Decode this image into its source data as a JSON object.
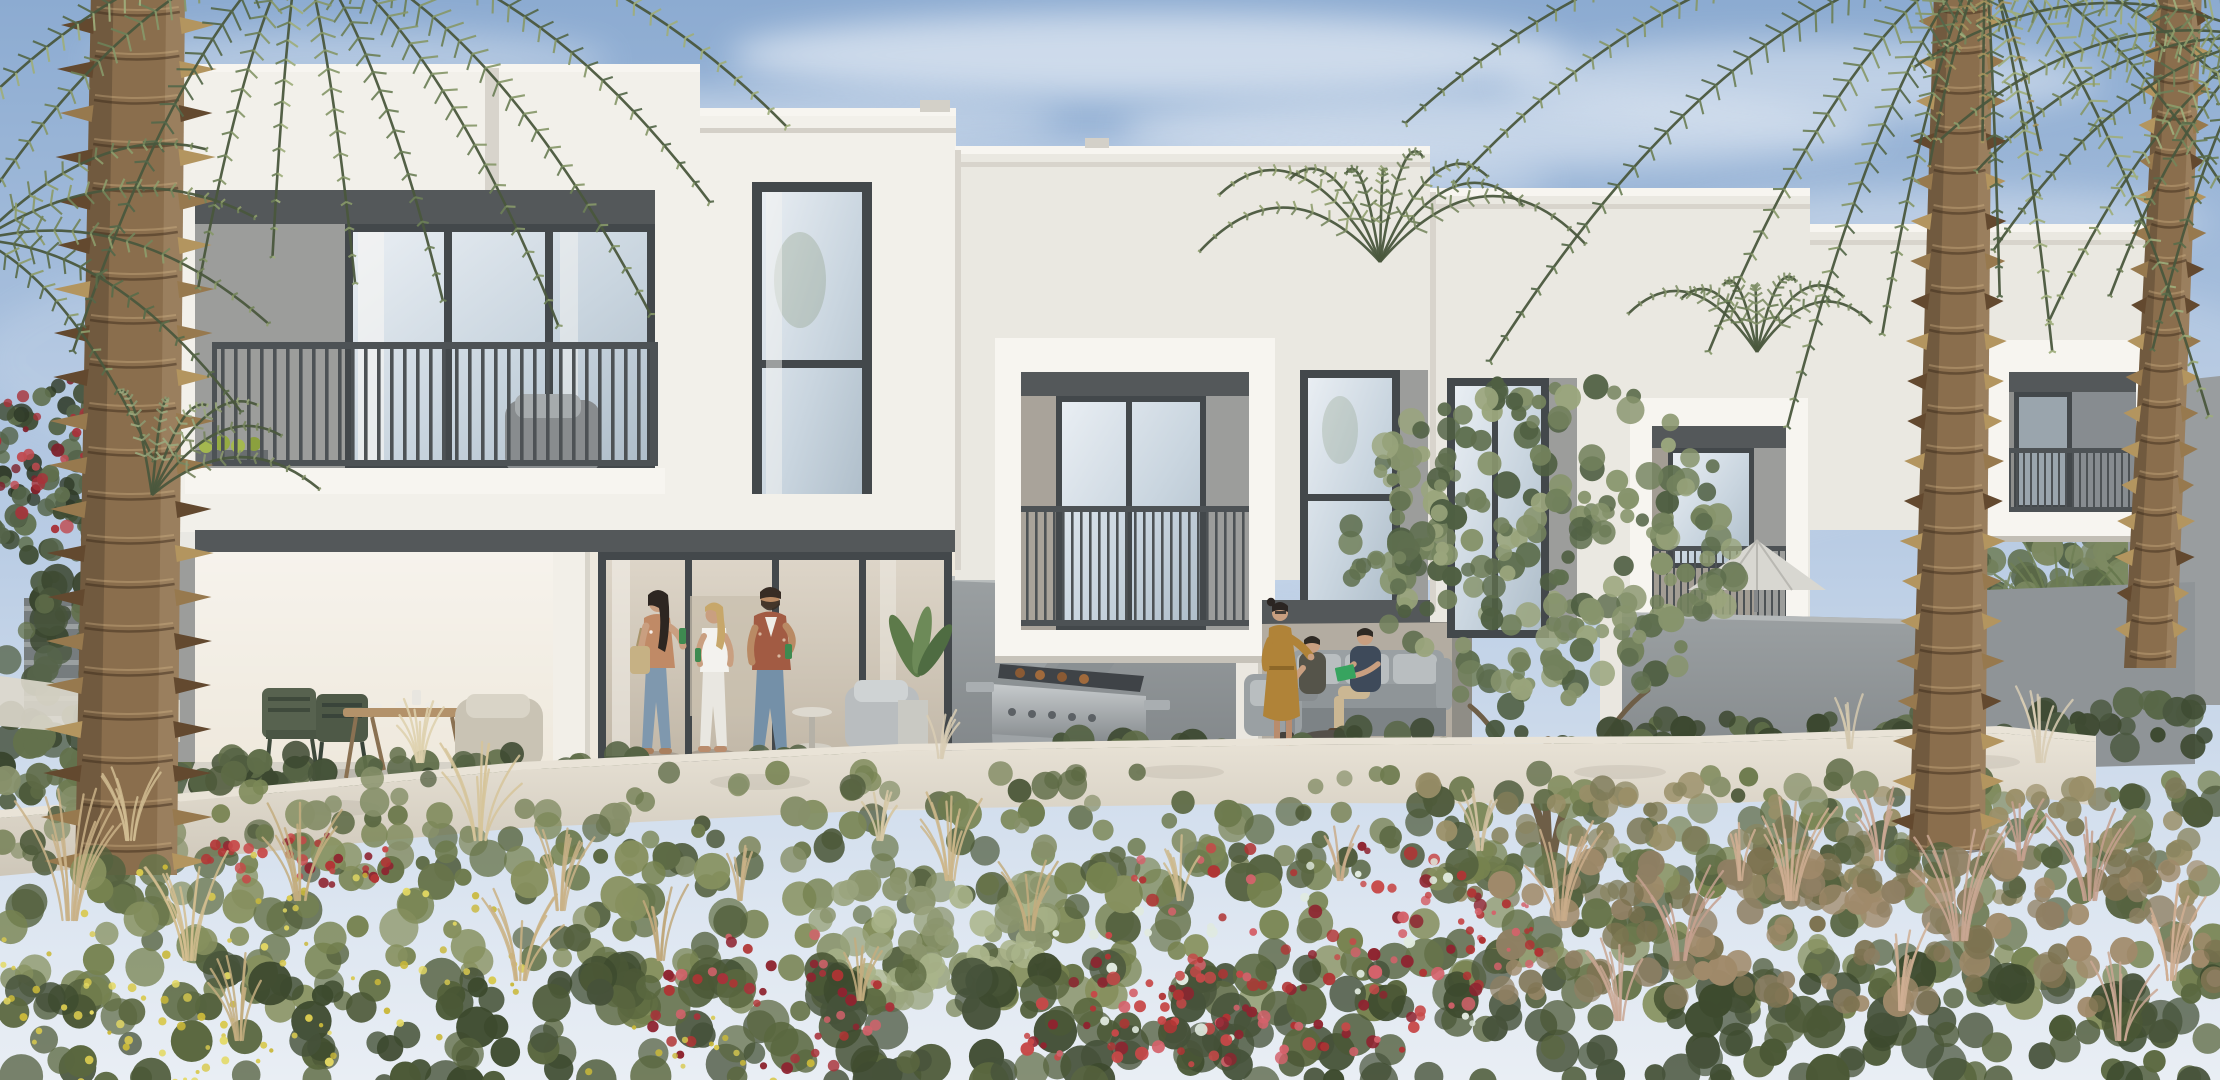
{
  "alt": "Architectural rendering of a row of modern white two-storey townhouses with dark-framed windows and balconies, ground-floor patios with people, outdoor furniture and a barbecue grill, palm trees on both sides, and a wild flowering garden with red and yellow blooms in the foreground under a soft blue sky",
  "scene": {
    "seed": 11,
    "colors": {
      "sky_top": "#8cabd1",
      "sky_mid": "#b9cce4",
      "sky_low": "#dde6f1",
      "facade": "#f2f0ea",
      "facade_bright": "#f7f5f0",
      "facade_dim": "#eae8e1",
      "facade_shade": "#d8d4cc",
      "soffit": "#54585a",
      "accent_panel": "#9c9d9b",
      "frame": "#43484b",
      "railing": "#4d5255",
      "glass_hi": "#e9eef3",
      "glass_mid": "#c9d5df",
      "glass_lo": "#aebdc9",
      "glass_warm_hi": "#ddd5c8",
      "glass_warm_lo": "#c2b8a8",
      "wall_grey_hi": "#9ba0a2",
      "wall_grey_lo": "#808588",
      "pilaster": "#eae7e0",
      "white_wall_hi": "#e9e3d7",
      "white_wall_lo": "#cec7b9",
      "patio_floor": "#d6d2c8",
      "curb": "#e5e1d6",
      "skin": "#c99f80",
      "skin_kid": "#d7ad8a",
      "denim": "#7f98ae",
      "rust": "#a25b43",
      "mustard": "#b08338",
      "navy": "#3e4a5a",
      "olive_shirt": "#55544a",
      "white_cloth": "#f2f1ec",
      "bottle": "#3e8a50",
      "book": "#37a45f",
      "red_shorts": "#c04436",
      "umbrella": "#d8d7d1",
      "bbq_steel": "#a9aeb1",
      "bbq_dark": "#4e5356",
      "sofa": "#9aa0a3",
      "cushion": "#b9bec0",
      "wood": "#b3926a",
      "chair_green": "#57624f",
      "pot": "#d4d4cf",
      "trunk": "#8a6e4d",
      "trunk_dark": "#63492f",
      "trunk_light": "#b3955f",
      "rachis": "#4a573d"
    },
    "clouds": [
      [
        1150,
        55,
        420,
        42,
        0.55
      ],
      [
        760,
        120,
        300,
        30,
        0.35
      ],
      [
        1500,
        130,
        380,
        36,
        0.45
      ],
      [
        1800,
        80,
        300,
        40,
        0.4
      ],
      [
        350,
        60,
        260,
        30,
        0.3
      ],
      [
        1050,
        180,
        500,
        40,
        0.3
      ],
      [
        1950,
        220,
        260,
        30,
        0.3
      ],
      [
        600,
        210,
        300,
        26,
        0.22
      ],
      [
        1100,
        420,
        900,
        160,
        0.16
      ],
      [
        1900,
        380,
        400,
        120,
        0.14
      ],
      [
        400,
        360,
        420,
        120,
        0.12
      ]
    ],
    "bg_clusters": [
      {
        "cx": 55,
        "cy": 480,
        "rx": 72,
        "ry": 98,
        "n": 80,
        "r0": 5,
        "r1": 12,
        "c": [
          "#3f4c33",
          "#55644a",
          "#2f3a28",
          "#60704e"
        ]
      },
      {
        "cx": 52,
        "cy": 448,
        "rx": 62,
        "ry": 84,
        "n": 30,
        "r0": 3,
        "r1": 7,
        "c": [
          "#a8323a",
          "#c04a50",
          "#7e222c"
        ]
      }
    ],
    "bg_bushes": [
      {
        "x0": 0,
        "x1": 250,
        "y0": 580,
        "y1": 860,
        "n": 130,
        "r0": 8,
        "r1": 18,
        "c": [
          "#47543a",
          "#56644a",
          "#3a462f",
          "#63714c"
        ]
      },
      {
        "x0": 1955,
        "x1": 2220,
        "y0": 548,
        "y1": 648,
        "n": 90,
        "r0": 7,
        "r1": 15,
        "c": [
          "#5f6e4c",
          "#6f7e57",
          "#4e5c40"
        ]
      },
      {
        "x0": 2020,
        "x1": 2210,
        "y0": 515,
        "y1": 605,
        "n": 55,
        "r0": 9,
        "r1": 17,
        "c": [
          "#6b7a55",
          "#7d8a62",
          "#5a6847"
        ]
      }
    ],
    "bg_fans": [
      [
        2060,
        645,
        12,
        95,
        64,
        "#6f7f55"
      ],
      [
        2160,
        655,
        12,
        100,
        64,
        "#65754c"
      ],
      [
        1995,
        650,
        10,
        75,
        44,
        "#778660"
      ],
      [
        1690,
        600,
        8,
        55,
        34,
        "#72815a"
      ],
      [
        1600,
        598,
        7,
        48,
        28,
        "#67764f"
      ]
    ],
    "hedges": [
      {
        "x0": 185,
        "x1": 985,
        "y": 752,
        "h": 44,
        "c": [
          "#47543a",
          "#556344",
          "#5f6d48",
          "#3c4830"
        ]
      },
      {
        "x0": 985,
        "x1": 1258,
        "y": 738,
        "h": 48,
        "c": [
          "#47543a",
          "#556344",
          "#5f6d48",
          "#3c4830"
        ]
      },
      {
        "x0": 1258,
        "x1": 1622,
        "y": 728,
        "h": 50,
        "c": [
          "#4a5840",
          "#586747",
          "#62704b",
          "#3e4a32"
        ]
      },
      {
        "x0": 1622,
        "x1": 2012,
        "y": 712,
        "h": 52,
        "c": [
          "#47543a",
          "#556344",
          "#5f6d48",
          "#3c4830"
        ]
      },
      {
        "x0": 2012,
        "x1": 2205,
        "y": 700,
        "h": 52,
        "c": [
          "#4a5840",
          "#586747",
          "#3e4a32"
        ]
      }
    ],
    "garden_a": [
      {
        "x0": 0,
        "x1": 2220,
        "y0": 772,
        "y1": 880,
        "n": 280,
        "r0": 7,
        "r1": 16,
        "c": [
          "#5d6a45",
          "#6d7a4e",
          "#7b8757",
          "#4e5a3b",
          "#87906a"
        ]
      },
      {
        "x0": 1420,
        "x1": 2220,
        "y0": 780,
        "y1": 900,
        "n": 120,
        "r0": 7,
        "r1": 14,
        "c": [
          "#8a8560",
          "#9a8f68",
          "#7d7a58"
        ]
      }
    ],
    "garden_b": [
      {
        "x0": 0,
        "x1": 2220,
        "y0": 848,
        "y1": 1012,
        "n": 330,
        "r0": 9,
        "r1": 20,
        "c": [
          "#55623f",
          "#67744a",
          "#76824f",
          "#86905e"
        ]
      },
      {
        "x0": 820,
        "x1": 1050,
        "y0": 878,
        "y1": 1000,
        "n": 70,
        "r0": 8,
        "r1": 16,
        "c": [
          "#9aa47e",
          "#aab48a",
          "#8a946c"
        ]
      },
      {
        "x0": 0,
        "x1": 2220,
        "y0": 968,
        "y1": 1085,
        "n": 300,
        "r0": 10,
        "r1": 22,
        "c": [
          "#46523a",
          "#4b5836",
          "#3d4a2e",
          "#5a673f"
        ]
      },
      {
        "x0": 1500,
        "x1": 2220,
        "y0": 860,
        "y1": 1010,
        "n": 130,
        "r0": 8,
        "r1": 16,
        "c": [
          "#8f7f63",
          "#a08a6a",
          "#7c7250"
        ]
      }
    ],
    "flowers": [
      {
        "cx": 1290,
        "cy": 952,
        "rx": 240,
        "ry": 118,
        "n": 120,
        "r0": 3,
        "r1": 7,
        "c": [
          "#b03434",
          "#c74848",
          "#8e2430",
          "#d4626b",
          "#e0eadf"
        ]
      },
      {
        "cx": 1180,
        "cy": 1042,
        "rx": 190,
        "ry": 72,
        "n": 60,
        "r0": 3,
        "r1": 7,
        "c": [
          "#b03434",
          "#c74848",
          "#8e2430",
          "#d4626b"
        ]
      },
      {
        "cx": 770,
        "cy": 1002,
        "rx": 130,
        "ry": 75,
        "n": 45,
        "r0": 3,
        "r1": 6,
        "c": [
          "#b03434",
          "#a8323a",
          "#d4626b",
          "#8e2430"
        ]
      },
      {
        "cx": 300,
        "cy": 858,
        "rx": 95,
        "ry": 34,
        "n": 36,
        "r0": 3,
        "r1": 6,
        "c": [
          "#b23636",
          "#c74848",
          "#8e2430"
        ]
      },
      {
        "cx": 1500,
        "cy": 935,
        "rx": 58,
        "ry": 36,
        "n": 16,
        "r0": 2,
        "r1": 5,
        "c": [
          "#b03434",
          "#d4626b"
        ]
      },
      {
        "cx": 250,
        "cy": 960,
        "rx": 280,
        "ry": 110,
        "n": 75,
        "r0": 2,
        "r1": 4.5,
        "c": [
          "#d8c94f",
          "#e4d963",
          "#c9b83a"
        ]
      },
      {
        "cx": 95,
        "cy": 1040,
        "rx": 150,
        "ry": 60,
        "n": 32,
        "r0": 2,
        "r1": 4.5,
        "c": [
          "#d8c94f",
          "#e4d963"
        ]
      },
      {
        "cx": 700,
        "cy": 1060,
        "rx": 120,
        "ry": 45,
        "n": 20,
        "r0": 2,
        "r1": 4,
        "c": [
          "#d8c94f",
          "#c9b83a"
        ]
      }
    ],
    "grass": [
      [
        70,
        920,
        12,
        120,
        52,
        "#c9b287"
      ],
      [
        190,
        960,
        10,
        100,
        44,
        "#d2bd8f"
      ],
      [
        300,
        900,
        9,
        90,
        40,
        "#c3ad7f"
      ],
      [
        480,
        840,
        10,
        90,
        40,
        "#d6c49a"
      ],
      [
        560,
        910,
        9,
        80,
        36,
        "#c9b287"
      ],
      [
        660,
        960,
        8,
        70,
        30,
        "#bfa87b"
      ],
      [
        950,
        880,
        10,
        80,
        36,
        "#ccb68a"
      ],
      [
        1030,
        930,
        8,
        70,
        30,
        "#c3ad7f"
      ],
      [
        1180,
        900,
        7,
        60,
        26,
        "#cdb88c"
      ],
      [
        1560,
        920,
        10,
        90,
        40,
        "#c9ab89"
      ],
      [
        1680,
        960,
        9,
        90,
        40,
        "#c4a08e"
      ],
      [
        1790,
        900,
        10,
        100,
        46,
        "#cfae93"
      ],
      [
        1960,
        940,
        11,
        110,
        50,
        "#c9a793"
      ],
      [
        2090,
        900,
        10,
        100,
        44,
        "#c4a08e"
      ],
      [
        2170,
        980,
        9,
        90,
        40,
        "#cfae93"
      ],
      [
        420,
        762,
        8,
        60,
        26,
        "#ddd0ab"
      ],
      [
        1480,
        850,
        7,
        60,
        24,
        "#d0bfa0"
      ],
      [
        880,
        840,
        7,
        55,
        22,
        "#d6c8a6"
      ],
      [
        1880,
        860,
        8,
        70,
        30,
        "#c9a793"
      ],
      [
        130,
        840,
        8,
        70,
        30,
        "#d0bc92"
      ],
      [
        740,
        900,
        7,
        60,
        24,
        "#c9b287"
      ],
      [
        1340,
        880,
        6,
        50,
        22,
        "#c9ab89"
      ],
      [
        2020,
        860,
        7,
        60,
        24,
        "#c4a08e"
      ],
      [
        1740,
        880,
        6,
        55,
        22,
        "#cfae93"
      ],
      [
        240,
        1040,
        9,
        80,
        34,
        "#c3ad7f"
      ],
      [
        1620,
        1020,
        8,
        80,
        34,
        "#c9a793"
      ],
      [
        2120,
        1040,
        8,
        80,
        36,
        "#c9a793"
      ],
      [
        860,
        1000,
        7,
        60,
        26,
        "#c3ad7f"
      ],
      [
        1900,
        1010,
        8,
        80,
        34,
        "#cfae93"
      ],
      [
        2040,
        762,
        8,
        70,
        30,
        "#d8cdb4"
      ],
      [
        1850,
        748,
        6,
        50,
        22,
        "#d4c8ae"
      ],
      [
        940,
        758,
        6,
        45,
        18,
        "#d8cdb4"
      ],
      [
        520,
        980,
        9,
        90,
        40,
        "#cab184"
      ]
    ],
    "olive": {
      "cx": 1545,
      "cy": 545,
      "rx": 200,
      "ry": 168,
      "n": 250,
      "r0": 6,
      "r1": 14,
      "c": [
        "#5e6e4e",
        "#72815c",
        "#87946c",
        "#9aa57c",
        "#4f5f42"
      ]
    },
    "crowns": [
      {
        "x": 300,
        "y": -60,
        "n": 12,
        "a0": 14,
        "a1": 166,
        "l0": 250,
        "l1": 540,
        "arch": 0.24,
        "droop": 0.1,
        "c": [
          "#55684a",
          "#6d8058",
          "#87986a",
          "#9fae7c"
        ]
      },
      {
        "x": -20,
        "y": 240,
        "n": 5,
        "a0": -30,
        "a1": 50,
        "l0": 170,
        "l1": 300,
        "arch": 0.22,
        "droop": 0.12,
        "c": [
          "#5a6c4a",
          "#74855b",
          "#8d9c6b"
        ]
      },
      {
        "x": 152,
        "y": 495,
        "n": 6,
        "a0": -100,
        "a1": -15,
        "l0": 110,
        "l1": 180,
        "arch": 0.3,
        "droop": 0.2,
        "c": [
          "#77855f",
          "#8c9870",
          "#9aa87d"
        ]
      },
      {
        "x": 1380,
        "y": 262,
        "n": 9,
        "a0": -160,
        "a1": -20,
        "l0": 120,
        "l1": 215,
        "arch": 0.35,
        "droop": 0.3,
        "c": [
          "#687a54",
          "#7b8a64",
          "#93a172"
        ]
      },
      {
        "x": 1757,
        "y": 352,
        "n": 7,
        "a0": -150,
        "a1": -30,
        "l0": 90,
        "l1": 150,
        "arch": 0.35,
        "droop": 0.3,
        "c": [
          "#6d7f58",
          "#82916a"
        ]
      },
      {
        "x": 1985,
        "y": -50,
        "n": 13,
        "a0": 8,
        "a1": 172,
        "l0": 300,
        "l1": 620,
        "arch": 0.24,
        "droop": 0.1,
        "c": [
          "#55684a",
          "#6d8058",
          "#87986a",
          "#9fae7c"
        ]
      },
      {
        "x": 1985,
        "y": -40,
        "n": 3,
        "a0": 70,
        "a1": 110,
        "l0": 150,
        "l1": 190,
        "arch": 0.1,
        "droop": 0.3,
        "c": [
          "#a5945f",
          "#8f7e4e"
        ]
      },
      {
        "x": 2268,
        "y": 40,
        "n": 9,
        "a0": 85,
        "a1": 185,
        "l0": 240,
        "l1": 330,
        "arch": 0.22,
        "droop": 0.12,
        "c": [
          "#5a6c4a",
          "#74855b",
          "#8d9c6b",
          "#9fae7c"
        ]
      }
    ],
    "trunks": [
      {
        "x1": 138,
        "y1": -10,
        "x2": 126,
        "y2": 875,
        "w1": 94,
        "w2": 102,
        "step": 22,
        "spiky": true
      },
      {
        "x1": 1963,
        "y1": -10,
        "x2": 1947,
        "y2": 850,
        "w1": 58,
        "w2": 76,
        "step": 20,
        "spiky": false
      },
      {
        "x1": 2180,
        "y1": -10,
        "x2": 2150,
        "y2": 668,
        "w1": 44,
        "w2": 52,
        "step": 18,
        "spiky": false
      }
    ]
  }
}
